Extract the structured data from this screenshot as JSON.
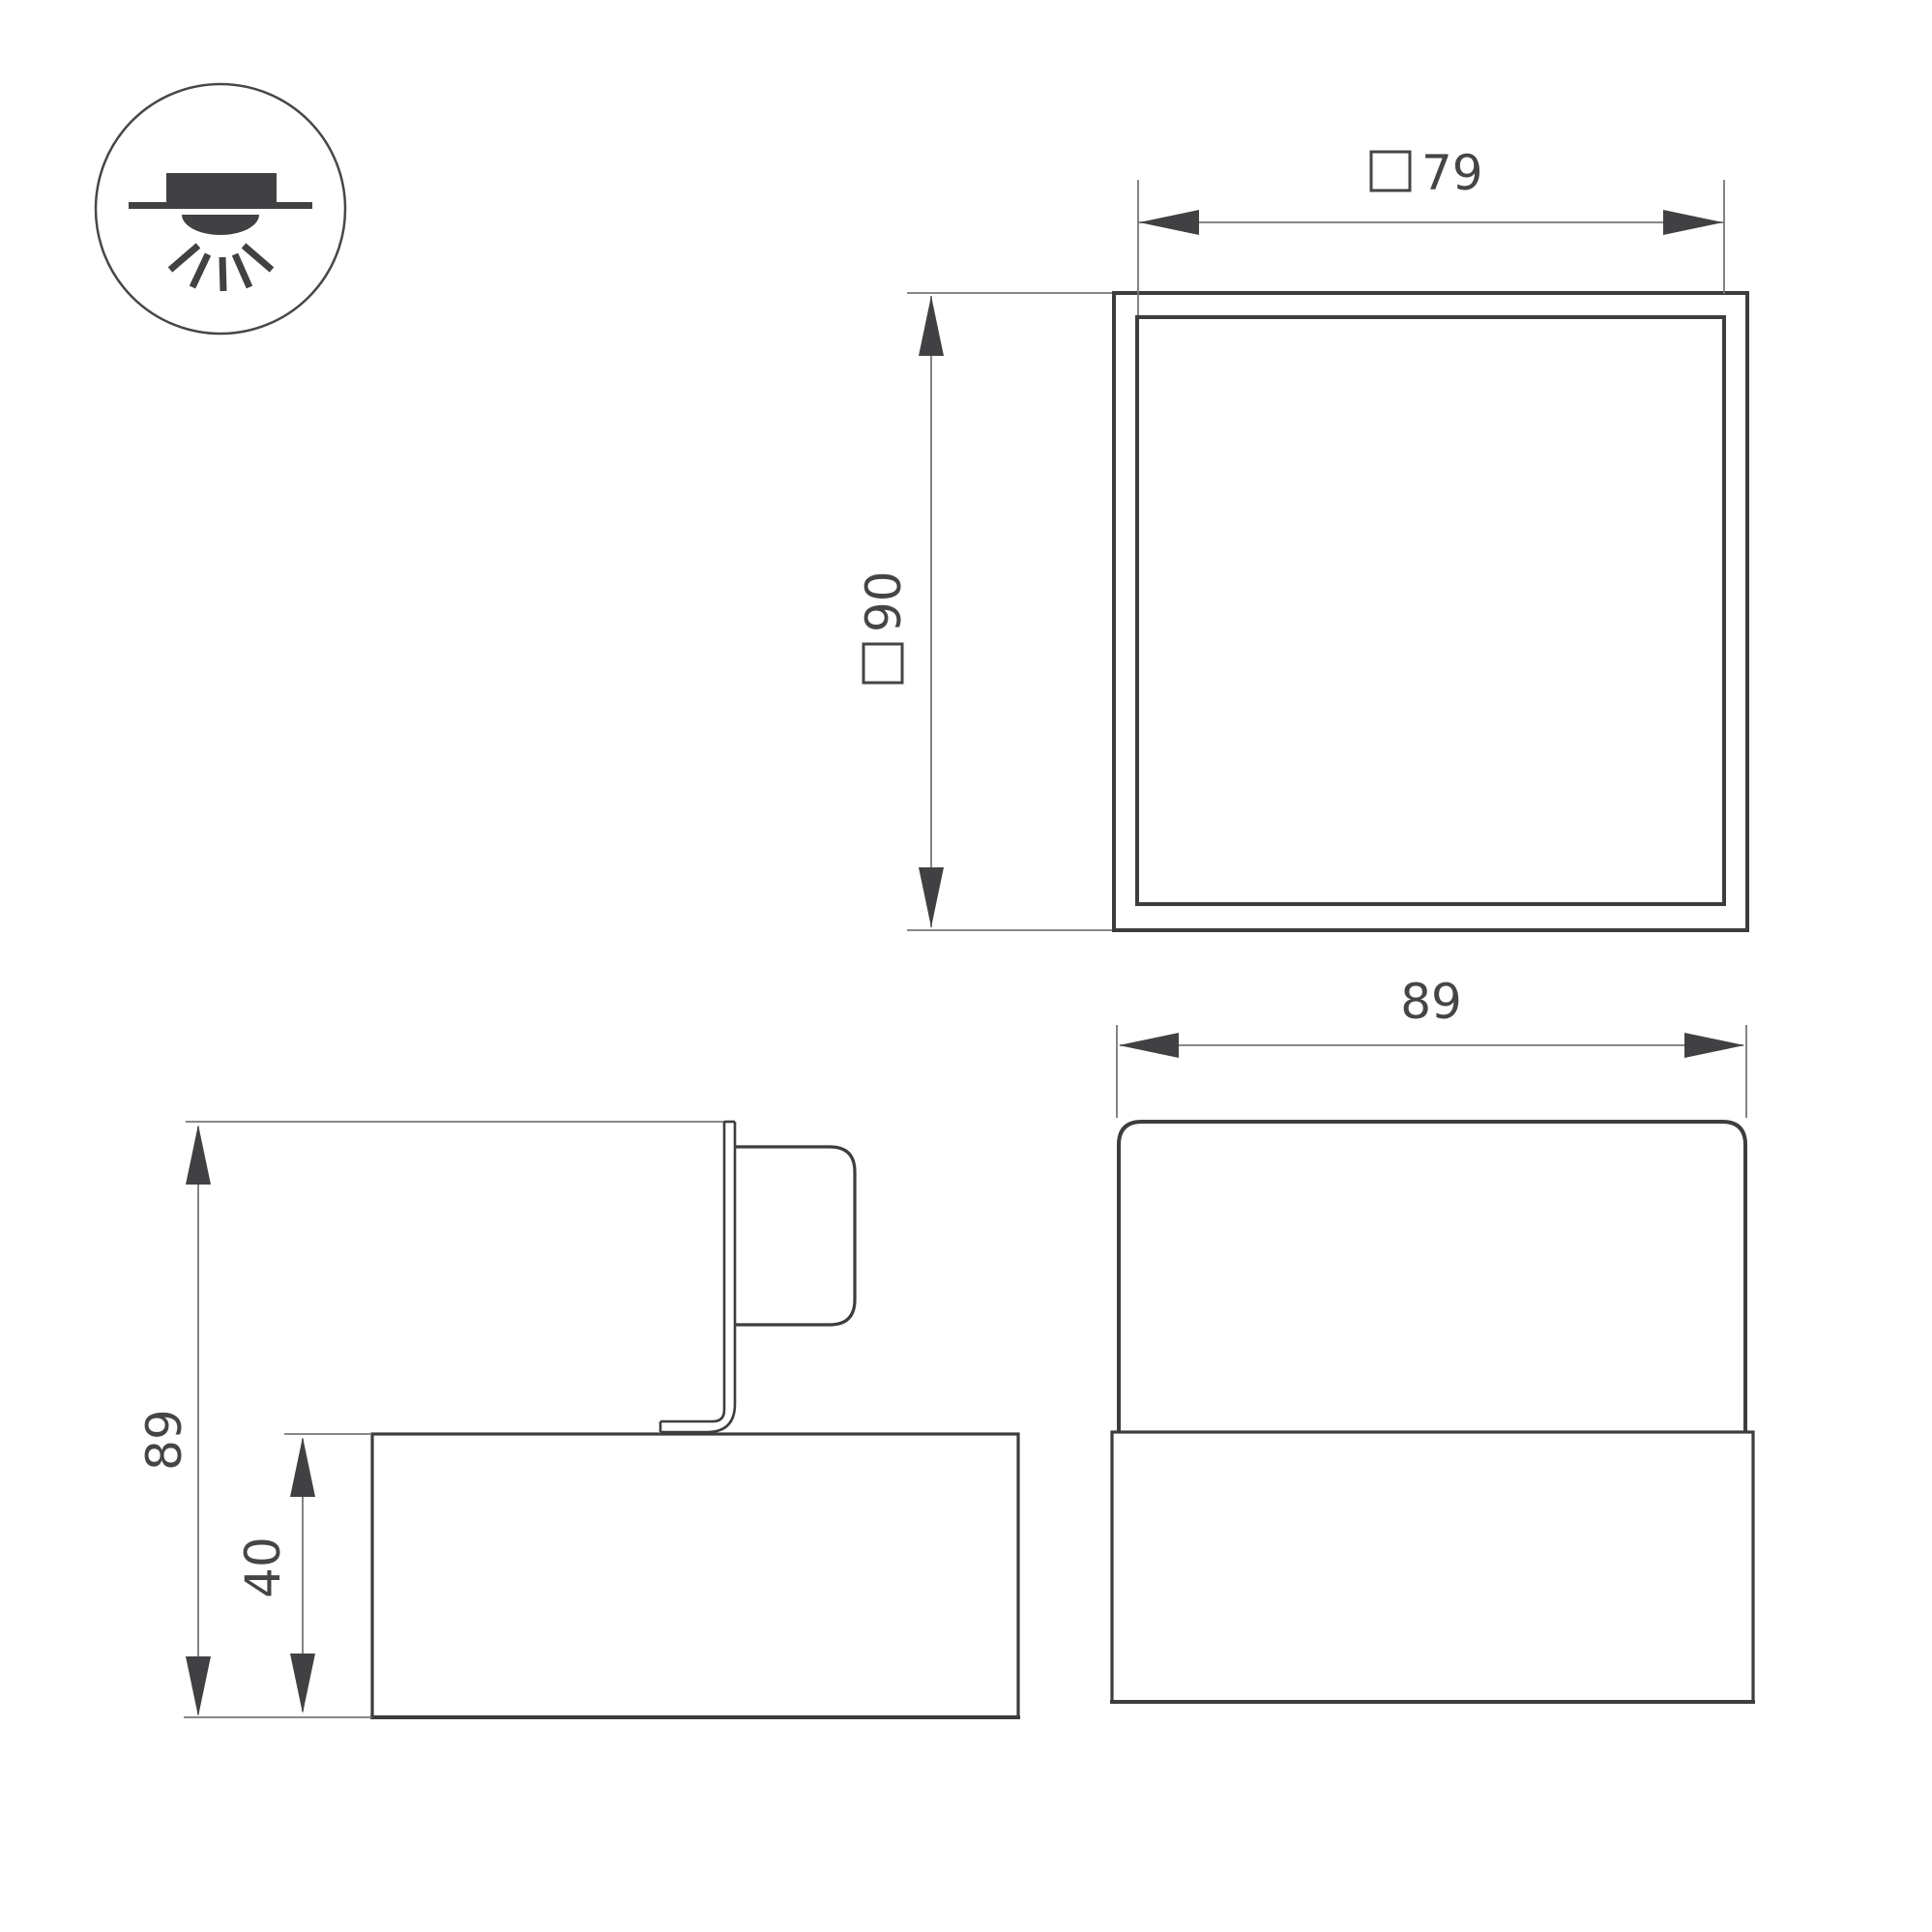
{
  "diagram": {
    "type": "luminaire-dimension-drawing",
    "colors": {
      "line": "#3d3d40",
      "thin_line": "#77777a",
      "arrow": "#414144",
      "text": "#454548",
      "background": "#ffffff"
    },
    "mount_icon": {
      "meaning": "surface-mounted-downlight"
    },
    "labels": {
      "top_view_aperture": {
        "symbol": "□",
        "value": "79"
      },
      "top_view_size": {
        "symbol": "□",
        "value": "90"
      },
      "side_view_height": {
        "value": "89"
      },
      "side_view_base_height": {
        "value": "40"
      },
      "front_view_width": {
        "value": "89"
      }
    }
  }
}
